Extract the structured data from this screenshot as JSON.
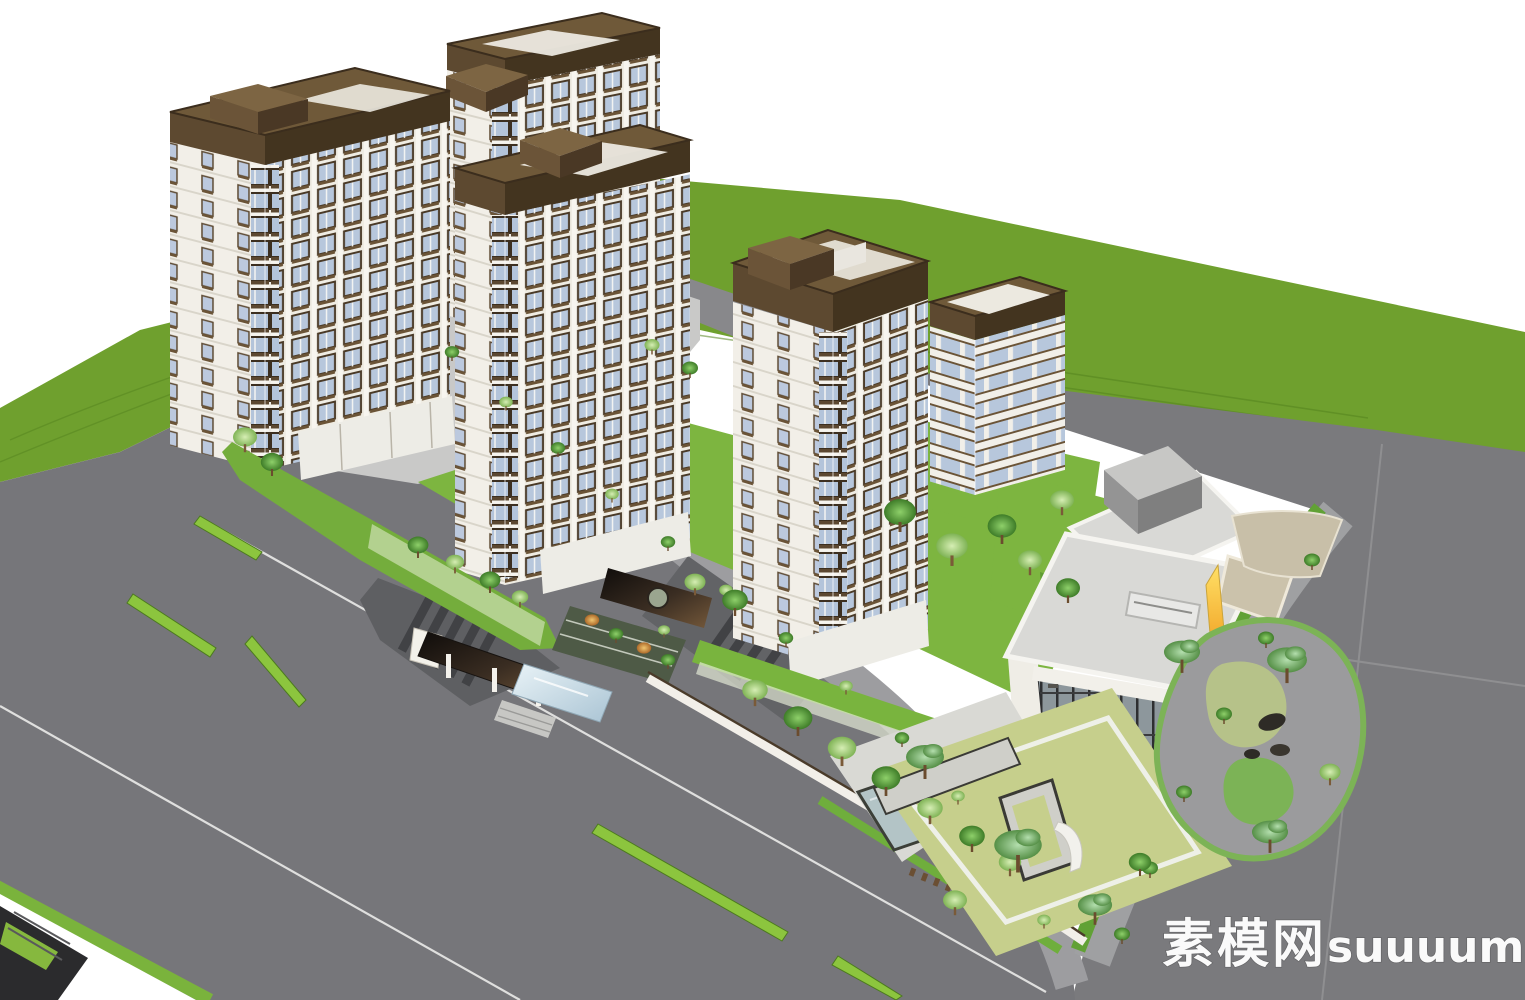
{
  "scene": {
    "type": "3d-architectural-aerial-render",
    "subject": "Residential compound: five white towers with brown trim, landscaped entrance with reflecting pool, clubhouse with yellow accent, roads and large green field",
    "watermark": {
      "cn": "素模网",
      "latin": "suuuum.com",
      "color": "#ffffff",
      "position": "bottom-right"
    },
    "towers": [
      {
        "id": "tower-1",
        "position": "upper-left",
        "approx_floors": 14
      },
      {
        "id": "tower-2",
        "position": "top-center",
        "approx_floors": 12
      },
      {
        "id": "tower-3",
        "position": "center-left",
        "approx_floors": 16
      },
      {
        "id": "tower-4",
        "position": "center-foreground",
        "approx_floors": 17
      },
      {
        "id": "tower-5",
        "position": "center-right-small",
        "approx_floors": 8
      }
    ],
    "clubhouse": {
      "id": "clubhouse-sales-center",
      "position": "right",
      "floors": 2,
      "features": [
        "flat-gray-roof",
        "roof-box",
        "glass-curtain-wall",
        "yellow-wedge-accent",
        "tan-terrace",
        "courtyard-lawn",
        "curvy-stone-garden"
      ]
    },
    "landscape": [
      "entry-gate-canopy",
      "reflecting-pool",
      "pergola-with-round-skylight",
      "terraced-garden",
      "green-hedge-berm",
      "planted-green-walls",
      "street-trees",
      "boundary-wall-with-project-sign",
      "courtyard-walkway-frame",
      "rock-garden"
    ],
    "roads": {
      "left_boulevard": {
        "green_median_segments": 5,
        "lane_lines": 2,
        "zebra_ramps": 2,
        "roadside_verge": true
      },
      "right_road": {
        "seam_lines": 2,
        "curved_corner": true
      },
      "upper_road": {
        "present": true
      }
    },
    "sign_note": "small brown characters on white boundary wall, illegible at source resolution"
  },
  "palette": {
    "sky": "#ffffff",
    "field_green": "#6fa02e",
    "inner_lawn": "#7db540",
    "courtyard_lawn": "#c6cf8c",
    "hedge_green": "#77b33c",
    "median_green": "#8cc53e",
    "road_gray": "#77777a",
    "sidewalk_gray": "#9d9da0",
    "plaza_gray": "#c9c9c8",
    "roof_brown": "#6f5939",
    "trim_brown_dark": "#4a3928",
    "facade_white": "#f2efe8",
    "window_blue": "#b7c7dc",
    "pool_blue": "#cfe2ee",
    "canopy_dark": "#241c15",
    "accent_yellow": "#ffd84d",
    "accent_orange": "#f0a32a",
    "watermark_white": "#ffffff"
  }
}
